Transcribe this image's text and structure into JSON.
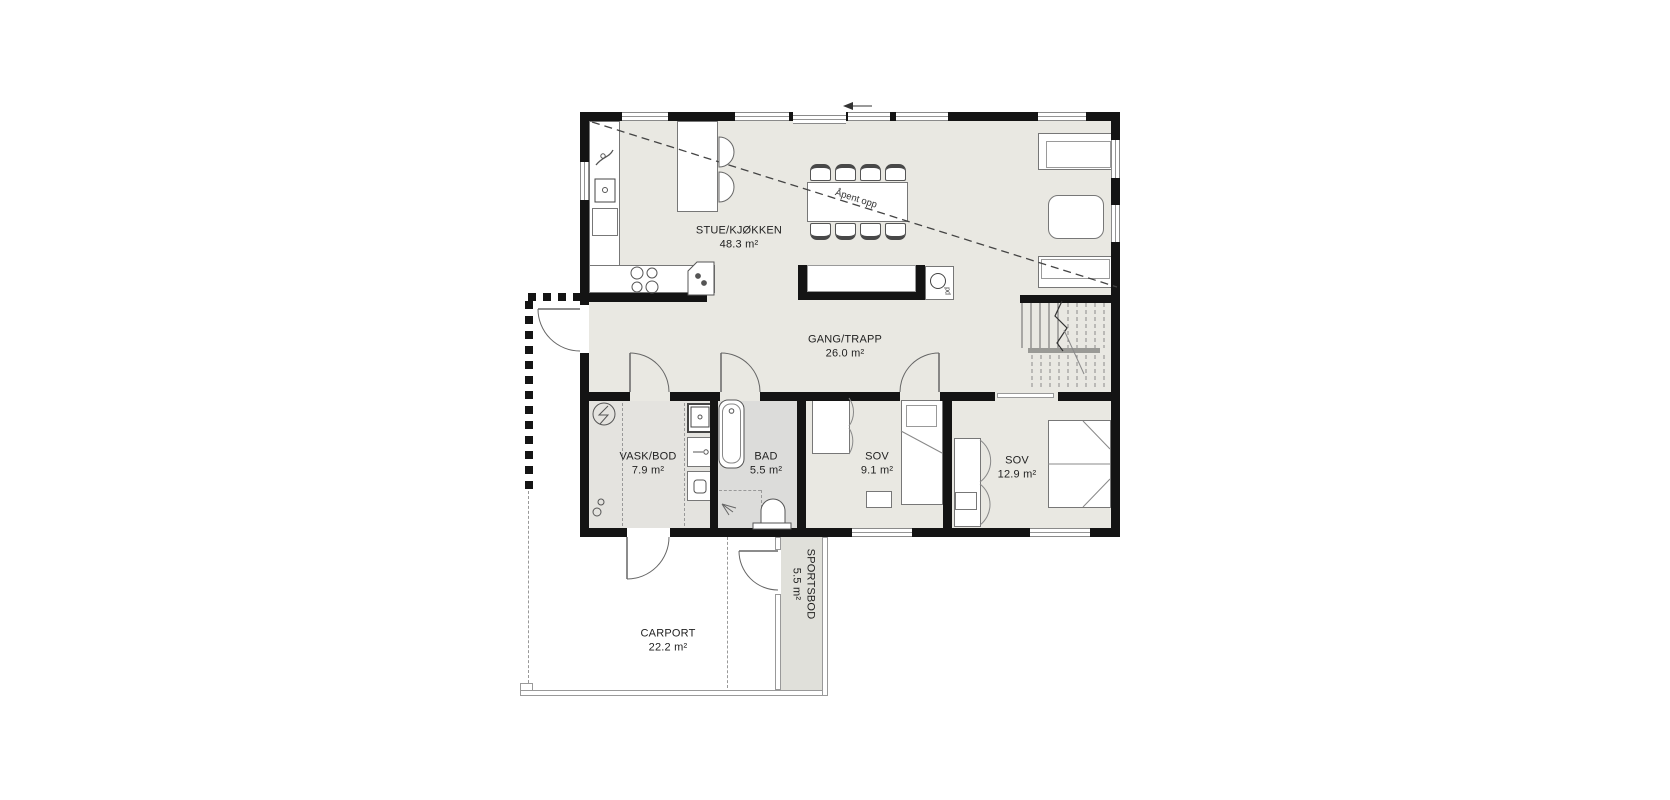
{
  "plan": {
    "rooms": [
      {
        "name": "STUE/KJØKKEN",
        "area": "48.3 m²"
      },
      {
        "name": "GANG/TRAPP",
        "area": "26.0 m²"
      },
      {
        "name": "VASK/BOD",
        "area": "7.9 m²"
      },
      {
        "name": "BAD",
        "area": "5.5 m²"
      },
      {
        "name": "SOV",
        "area": "9.1 m²"
      },
      {
        "name": "SOV",
        "area": "12.9 m²"
      },
      {
        "name": "CARPORT",
        "area": "22.2 m²"
      },
      {
        "name": "SPORTSBOD",
        "area": "5.5 m²"
      }
    ],
    "annotations": {
      "open_above": "Åpent opp",
      "flue": "pd"
    },
    "colors": {
      "wall": "#141414",
      "floor_main": "#e9e8e2",
      "floor_laundry": "#e4e3df",
      "floor_bath": "#dcdcda",
      "floor_storage": "#e0e0da",
      "linework": "#666666"
    }
  }
}
